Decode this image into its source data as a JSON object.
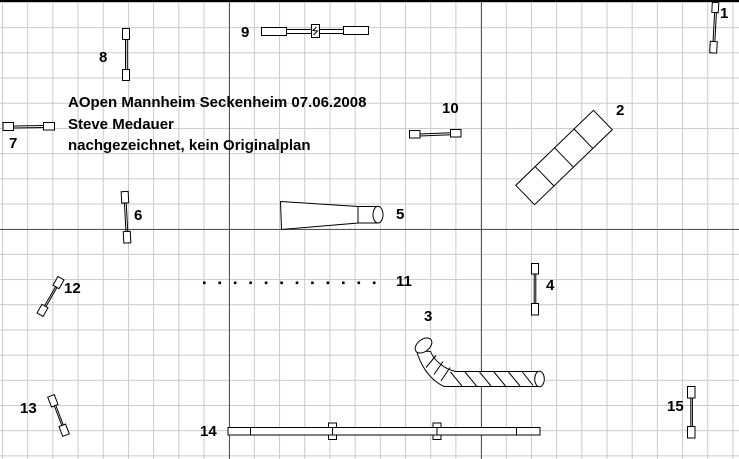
{
  "title_block": {
    "event": "AOpen Mannheim Seckenheim 07.06.2008",
    "author": "Steve Medauer",
    "note": "nachgezeichnet, kein Originalplan"
  },
  "obstacles": [
    {
      "label": "1",
      "type": "hurdle"
    },
    {
      "label": "2",
      "type": "wall"
    },
    {
      "label": "3",
      "type": "pipe-tunnel"
    },
    {
      "label": "4",
      "type": "hurdle"
    },
    {
      "label": "5",
      "type": "collapsed-tunnel"
    },
    {
      "label": "6",
      "type": "hurdle"
    },
    {
      "label": "7",
      "type": "hurdle"
    },
    {
      "label": "8",
      "type": "hurdle"
    },
    {
      "label": "9",
      "type": "spread-jump"
    },
    {
      "label": "10",
      "type": "hurdle"
    },
    {
      "label": "11",
      "type": "weave-poles",
      "pole_count": 12
    },
    {
      "label": "12",
      "type": "hurdle"
    },
    {
      "label": "13",
      "type": "hurdle"
    },
    {
      "label": "14",
      "type": "dog-walk"
    },
    {
      "label": "15",
      "type": "hurdle"
    }
  ],
  "colors": {
    "background": "#ffffff",
    "grid_minor": "#c9c9c9",
    "grid_major": "#555555",
    "obstacle_line": "#000000",
    "text": "#000000"
  }
}
